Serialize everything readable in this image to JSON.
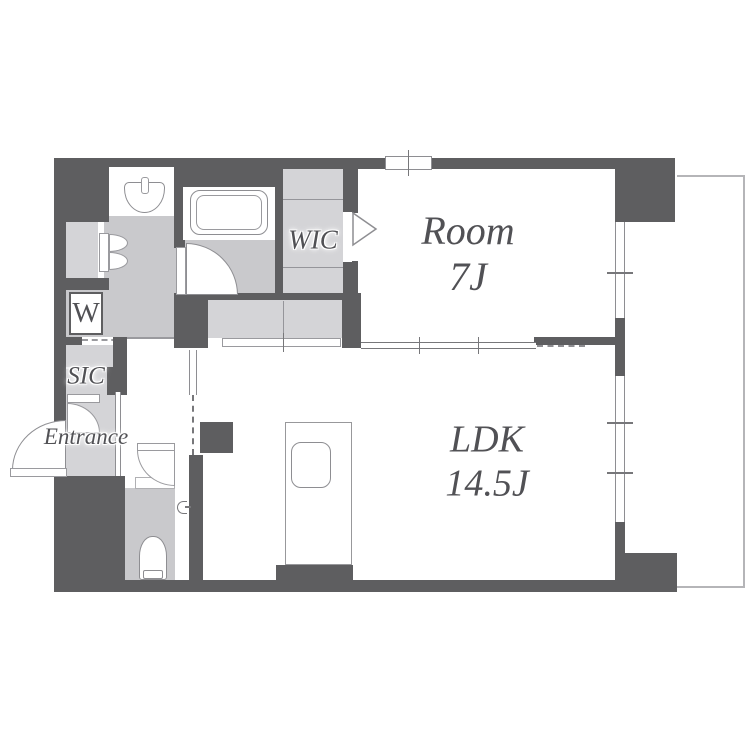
{
  "plan": {
    "title": "1LDK apartment floor plan",
    "labels": {
      "room_name": "Room",
      "room_size": "7J",
      "ldk_name": "LDK",
      "ldk_size": "14.5J",
      "wic": "WIC",
      "sic": "SIC",
      "entrance": "Entrance",
      "washer": "W"
    },
    "colors": {
      "wall": "#5e5e60",
      "floor": "#c9c9cc",
      "closet": "#d4d4d7",
      "outline": "#8e8e92",
      "balcony": "#b5b5b8",
      "label": "#515155"
    }
  }
}
